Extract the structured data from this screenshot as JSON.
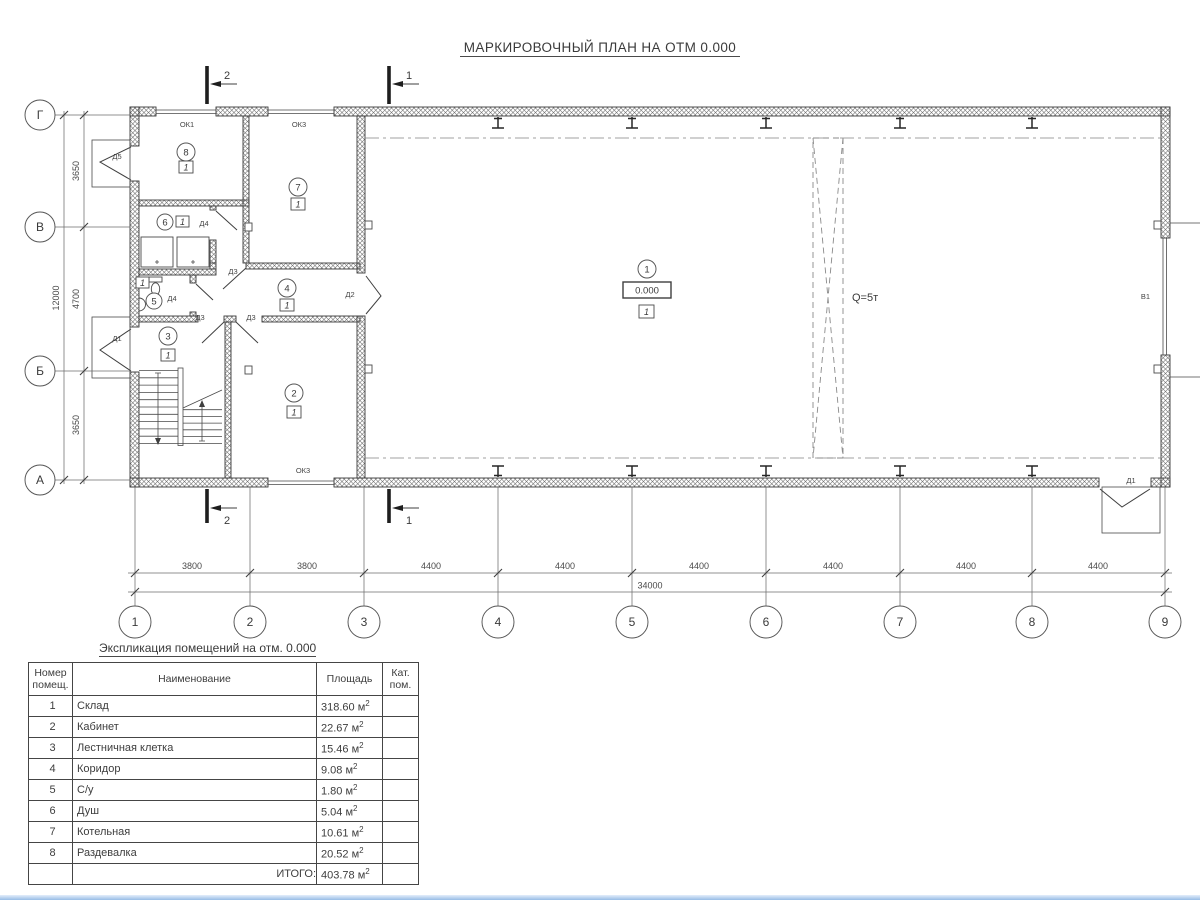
{
  "title": "МАРКИРОВОЧНЫЙ ПЛАН НА ОТМ 0.000",
  "plan": {
    "sections": {
      "s1": "1",
      "s2": "2"
    },
    "axes_h": [
      "1",
      "2",
      "3",
      "4",
      "5",
      "6",
      "7",
      "8",
      "9"
    ],
    "axes_v": [
      "Г",
      "В",
      "Б",
      "А"
    ],
    "dims_bottom": [
      "3800",
      "3800",
      "4400",
      "4400",
      "4400",
      "4400",
      "4400",
      "4400"
    ],
    "total_bottom": "34000",
    "dims_left": [
      "3650",
      "4700",
      "3650"
    ],
    "total_left": "12000",
    "rooms": {
      "r1": "1",
      "r2": "2",
      "r3": "3",
      "r4": "4",
      "r5": "5",
      "r6": "6",
      "r7": "7",
      "r8": "8"
    },
    "marks": {
      "cat": "1",
      "elevation": "0.000",
      "crane": "Q=5т",
      "gate": "В1"
    },
    "doors": {
      "d1": "Д1",
      "d2": "Д2",
      "d3": "Д3",
      "d4": "Д4",
      "d5": "Д5"
    },
    "windows": {
      "ok1": "ОК1",
      "ok3": "ОК3"
    }
  },
  "schedule": {
    "caption": "Экспликация помещений на отм. 0.000",
    "col_num": "Номер помещ.",
    "col_name": "Наименование",
    "col_area": "Площадь",
    "col_cat": "Кат. пом.",
    "unit": "м",
    "unit_sup": "2",
    "rows": [
      {
        "num": "1",
        "name": "Склад",
        "area": "318.60"
      },
      {
        "num": "2",
        "name": "Кабинет",
        "area": "22.67"
      },
      {
        "num": "3",
        "name": "Лестничная клетка",
        "area": "15.46"
      },
      {
        "num": "4",
        "name": "Коридор",
        "area": "9.08"
      },
      {
        "num": "5",
        "name": "С/у",
        "area": "1.80"
      },
      {
        "num": "6",
        "name": "Душ",
        "area": "5.04"
      },
      {
        "num": "7",
        "name": "Котельная",
        "area": "10.61"
      },
      {
        "num": "8",
        "name": "Раздевалка",
        "area": "20.52"
      }
    ],
    "total_label": "ИТОГО:",
    "total_area": "403.78"
  }
}
